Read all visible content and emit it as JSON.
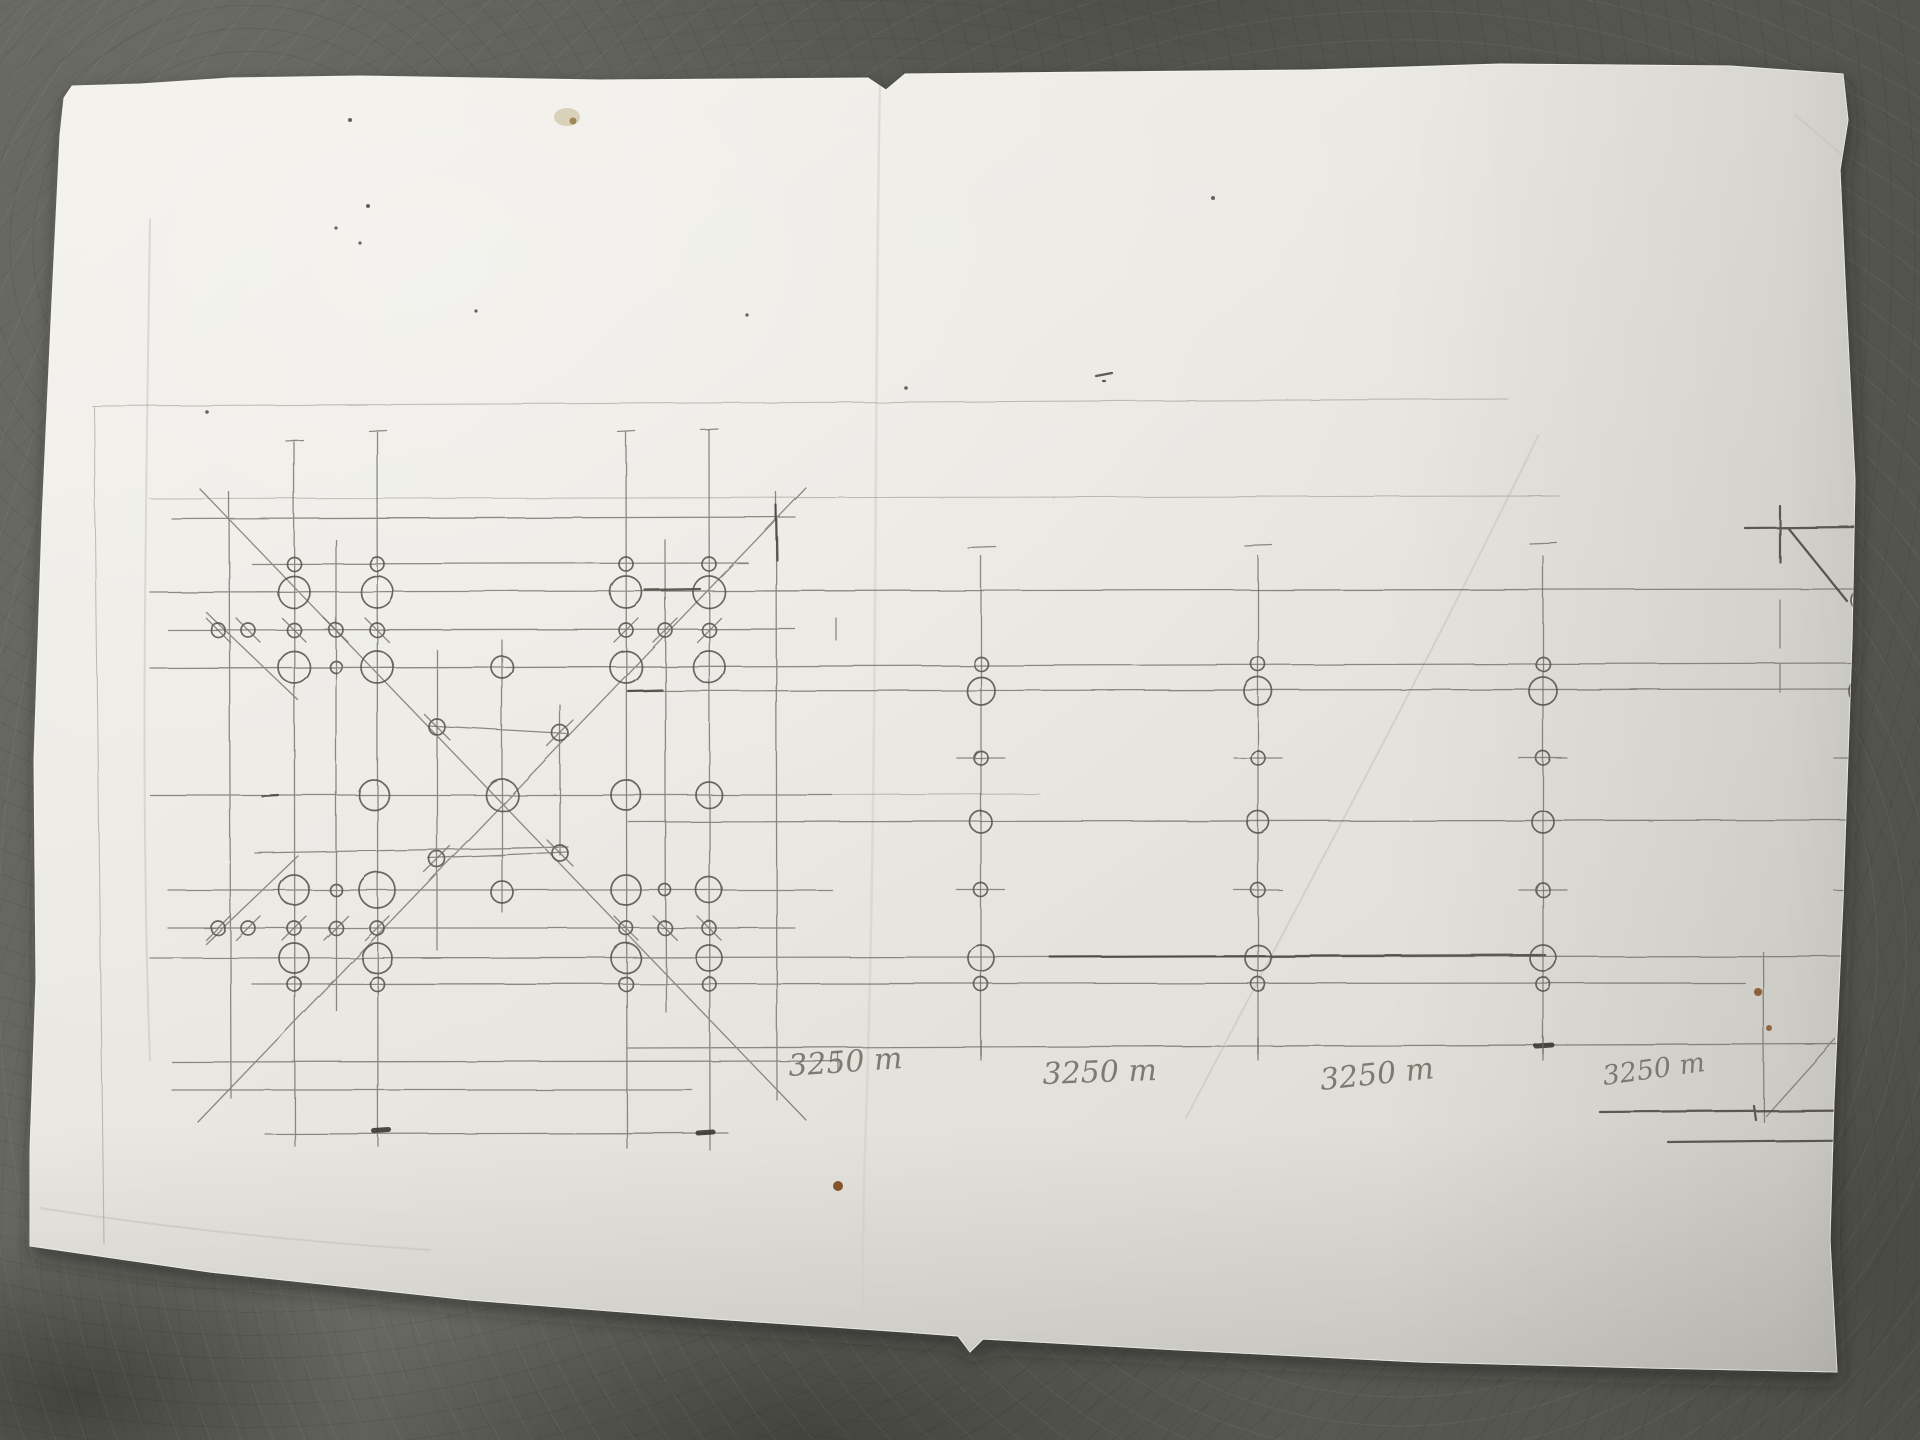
{
  "scene": {
    "description": "Photograph of a hand-drawn pencil engineering sketch on a loose white sheet of paper lying on a gray concrete floor",
    "subject": "bolted truss elevation with X-braced gusset panel and repeated bolted posts"
  },
  "colors": {
    "paper": "#eae8e2",
    "floor": "#5c5d56",
    "pencil": "#6f6b64",
    "pencil_dark": "#45423c",
    "rust_stain": "#7d4418",
    "yellow_stain": "#c9bd9b"
  },
  "drawing": {
    "dimension_labels": [
      {
        "text": "3250 m"
      },
      {
        "text": "3250 m"
      },
      {
        "text": "3250 m"
      },
      {
        "text": "3250 m"
      }
    ],
    "panel_bolts": [
      [
        294,
        564,
        7
      ],
      [
        377,
        564,
        7
      ],
      [
        626,
        564,
        7
      ],
      [
        709,
        564,
        7
      ],
      [
        294,
        592,
        16
      ],
      [
        377,
        592,
        16
      ],
      [
        626,
        592,
        16
      ],
      [
        709,
        592,
        16
      ],
      [
        218,
        630,
        7,
        "\\"
      ],
      [
        248,
        630,
        7,
        "\\"
      ],
      [
        294,
        630,
        7,
        "\\"
      ],
      [
        336,
        630,
        7,
        "\\"
      ],
      [
        377,
        630,
        7,
        "\\"
      ],
      [
        626,
        630,
        7,
        "/"
      ],
      [
        665,
        630,
        7,
        "/"
      ],
      [
        709,
        630,
        7,
        "/"
      ],
      [
        294,
        667,
        16
      ],
      [
        377,
        667,
        16
      ],
      [
        626,
        667,
        16
      ],
      [
        709,
        667,
        16
      ],
      [
        502,
        667,
        11
      ],
      [
        336,
        667,
        6
      ],
      [
        437,
        727,
        8,
        "\\"
      ],
      [
        560,
        733,
        8,
        "/"
      ],
      [
        374,
        795,
        15
      ],
      [
        502,
        795,
        16
      ],
      [
        626,
        795,
        15
      ],
      [
        709,
        795,
        13
      ],
      [
        437,
        859,
        8,
        "/"
      ],
      [
        560,
        853,
        8,
        "\\"
      ],
      [
        294,
        890,
        15
      ],
      [
        336,
        890,
        6
      ],
      [
        377,
        890,
        18
      ],
      [
        502,
        892,
        11
      ],
      [
        626,
        890,
        15
      ],
      [
        665,
        890,
        6
      ],
      [
        709,
        890,
        13
      ],
      [
        218,
        928,
        7,
        "/"
      ],
      [
        248,
        928,
        7,
        "/"
      ],
      [
        294,
        928,
        7,
        "/"
      ],
      [
        336,
        928,
        7,
        "/"
      ],
      [
        377,
        928,
        7,
        "/"
      ],
      [
        626,
        928,
        7,
        "\\"
      ],
      [
        665,
        928,
        7,
        "\\"
      ],
      [
        709,
        928,
        7,
        "\\"
      ],
      [
        294,
        958,
        15
      ],
      [
        377,
        958,
        15
      ],
      [
        626,
        958,
        15
      ],
      [
        709,
        958,
        13
      ],
      [
        294,
        984,
        7
      ],
      [
        377,
        984,
        7
      ],
      [
        626,
        984,
        7
      ],
      [
        709,
        984,
        7
      ]
    ],
    "truss": {
      "post_x": [
        981,
        1258,
        1543
      ],
      "post_top": 556,
      "post_bottom": 1060,
      "post_circles": [
        [
          664,
          7,
          0
        ],
        [
          691,
          14,
          0
        ],
        [
          758,
          7,
          1
        ],
        [
          822,
          11,
          0
        ],
        [
          890,
          7,
          1
        ],
        [
          958,
          13,
          0
        ],
        [
          984,
          7,
          0
        ]
      ]
    },
    "edge_arcs": [
      [
        600,
        11
      ],
      [
        691,
        13
      ],
      [
        822,
        11
      ],
      [
        958,
        13
      ],
      [
        1040,
        13
      ]
    ],
    "edge_ticks": [
      758,
      890
    ]
  }
}
